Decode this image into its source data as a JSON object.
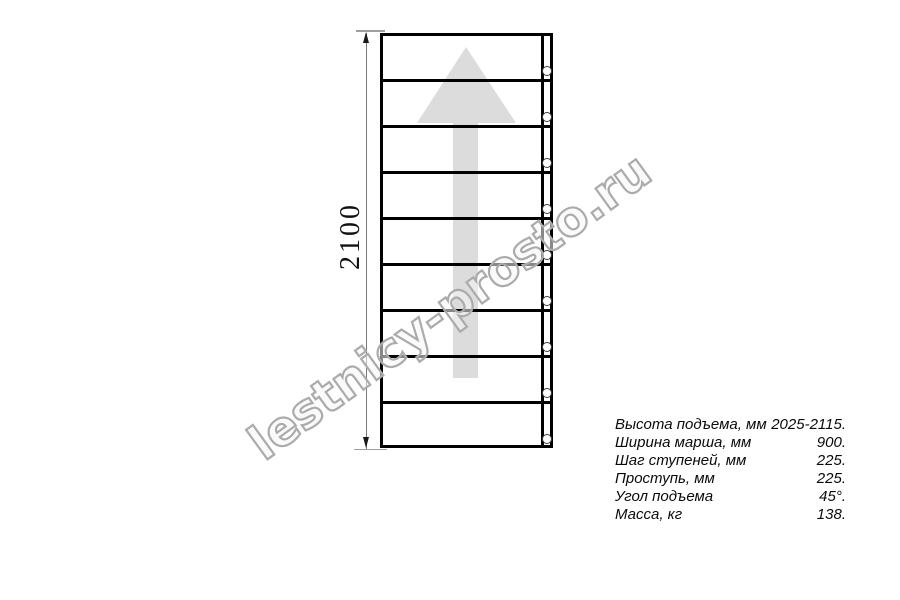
{
  "drawing": {
    "height_label": "2100",
    "arrow_direction": "up",
    "tread_count": 9,
    "bolt_count": 9,
    "tread_pitch_px": 46
  },
  "specs": {
    "rows": [
      {
        "label": "Высота подъема, мм",
        "value": "2025-2115."
      },
      {
        "label": "Ширина марша, мм",
        "value": "900."
      },
      {
        "label": "Шаг ступеней, мм",
        "value": "225."
      },
      {
        "label": "Проступь, мм",
        "value": "225."
      },
      {
        "label": "Угол подъема",
        "value": "45°."
      },
      {
        "label": "Масса, кг",
        "value": "138."
      }
    ]
  },
  "watermark": {
    "text": "lestnicy-prosto.ru"
  },
  "colors": {
    "line": "#000000",
    "arrow_fill": "#dcdcdc",
    "dimension_line": "#7a7a7a",
    "extension_line": "#9f9f9f",
    "watermark_stroke": "#ababab"
  }
}
